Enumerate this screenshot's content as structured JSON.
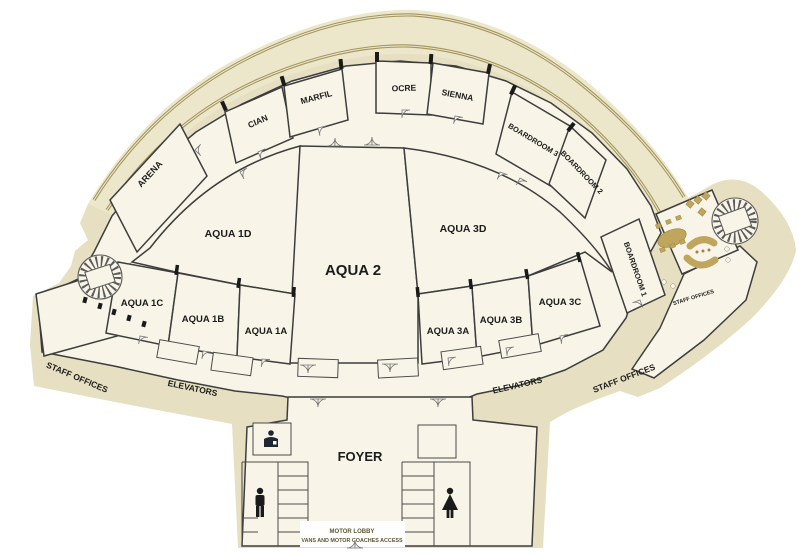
{
  "plan_title": "Convention level floor plan",
  "rooms": {
    "arena": {
      "label": "ARENA"
    },
    "cian": {
      "label": "CIAN"
    },
    "marfil": {
      "label": "MARFIL"
    },
    "ocre": {
      "label": "OCRE"
    },
    "sienna": {
      "label": "SIENNA"
    },
    "boardroom3": {
      "label": "BOARDROOM 3"
    },
    "boardroom2": {
      "label": "BOARDROOM 2"
    },
    "boardroom1": {
      "label": "BOARDROOM 1"
    },
    "aqua1d": {
      "label": "AQUA 1D"
    },
    "aqua2": {
      "label": "AQUA 2"
    },
    "aqua3d": {
      "label": "AQUA 3D"
    },
    "aqua1c": {
      "label": "AQUA 1C"
    },
    "aqua1b": {
      "label": "AQUA 1B"
    },
    "aqua1a": {
      "label": "AQUA 1A"
    },
    "aqua3a": {
      "label": "AQUA 3A"
    },
    "aqua3b": {
      "label": "AQUA 3B"
    },
    "aqua3c": {
      "label": "AQUA 3C"
    },
    "foyer": {
      "label": "FOYER"
    }
  },
  "areas": {
    "staff_offices_left": "STAFF OFFICES",
    "elevators_left": "ELEVATORS",
    "elevators_right": "ELEVATORS",
    "staff_offices_right": "STAFF OFFICES",
    "staff_offices_room": "STAFF OFFICES",
    "motor_lobby": "MOTOR LOBBY",
    "vans_access": "VANS AND MOTOR COACHES ACCESS"
  },
  "icons": {
    "concierge": "concierge-desk-icon",
    "male": "male-restroom-icon",
    "female": "female-restroom-icon",
    "stair_left": "spiral-staircase",
    "stair_right": "spiral-staircase"
  },
  "colors": {
    "footprint": "#e6dfc1",
    "promenade_band": "#ece6ca",
    "band_stripe": "#a2945c",
    "floor": "#f8f4e7",
    "wall": "#3d3d3d",
    "furniture": "#bfa65c",
    "icon_dark": "#1f2733",
    "text": "#1c1c1c",
    "motor_text": "#5f5531"
  }
}
